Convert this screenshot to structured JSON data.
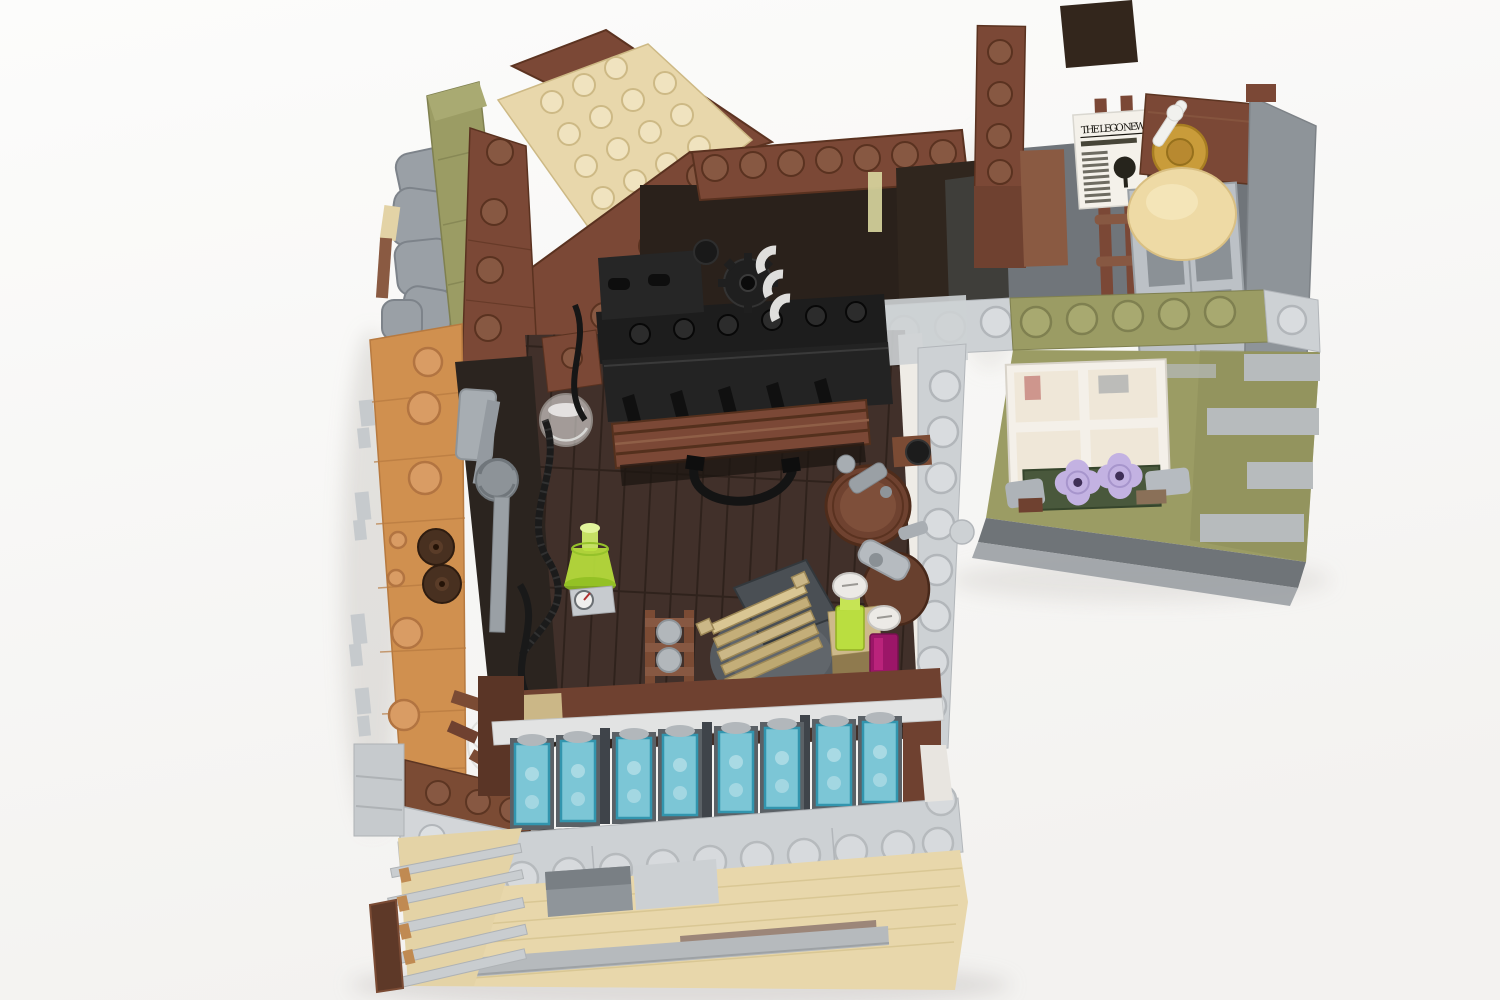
{
  "scene": {
    "type": "photograph",
    "subject": "LEGO modular building interior seen from above at a three-quarter angle, L-shaped, lid/roof removed",
    "setting": "seamless white studio background with soft shadows",
    "left_room_features": [
      "dark-brown plank floor",
      "black printing-press machine with toothed gear and white paper arches",
      "reddish-brown corrugated awning over black machinery",
      "grey distilling pipes with ribbed coupling and black coiled hoses",
      "trans-bright-green conical bottle and gauge tile",
      "wooden barrel with grey tap, second barrel behind table",
      "round grey table with rotated dark-grey top and stack of tan slats",
      "small side table with lime bottle and magenta bottle, both with white caps",
      "floor hatch ladder with grey rollers",
      "row of eight trans-light-blue interior window panes",
      "clear ribbed cylinder glassware"
    ],
    "right_room_features": [
      "grey floor",
      "white newspaper tile lying on floor",
      "reddish-brown counter with pearl-gold tap and white lever",
      "round tan loaf on light-grey lattice chair back",
      "reddish-brown ladder rails and corner pillar with studs"
    ],
    "exterior_features": [
      "olive-green wall with staggered light-grey quoins",
      "white four-pane window with warm reflections",
      "dark-green window box with two lavender flowers and grey brackets",
      "light-grey studded top plates along wall edges",
      "tan lower wall with grey door recess, grey ledges and base strips",
      "medium-nougat sloped side wall with studs and grey clips",
      "olive-green roof slope, grey rock pieces, tan and reddish-brown roof plates"
    ]
  },
  "newspaper": {
    "title": "THE LEGO NEWS"
  },
  "palette": {
    "background": "#fafaf9",
    "floor_brown": "#41302a",
    "reddish_brown": "#7b4836",
    "barrel_brown": "#6f4230",
    "dark_brown": "#30261e",
    "medium_nougat": "#d0904f",
    "tan": "#e8d7ab",
    "olive_green": "#9b9c64",
    "light_grey": "#cdd1d4",
    "mid_grey": "#8e9499",
    "dark_grey": "#5a5f63",
    "black": "#1e1e1e",
    "white_plastic": "#f4f1ea",
    "trans_light_blue": "#7fcfe0",
    "trans_teal_frame": "#2f9ab5",
    "trans_bright_green": "#b9e03c",
    "magenta": "#9c1668",
    "lavender": "#c3b2e2",
    "pearl_gold": "#c99c3a"
  }
}
